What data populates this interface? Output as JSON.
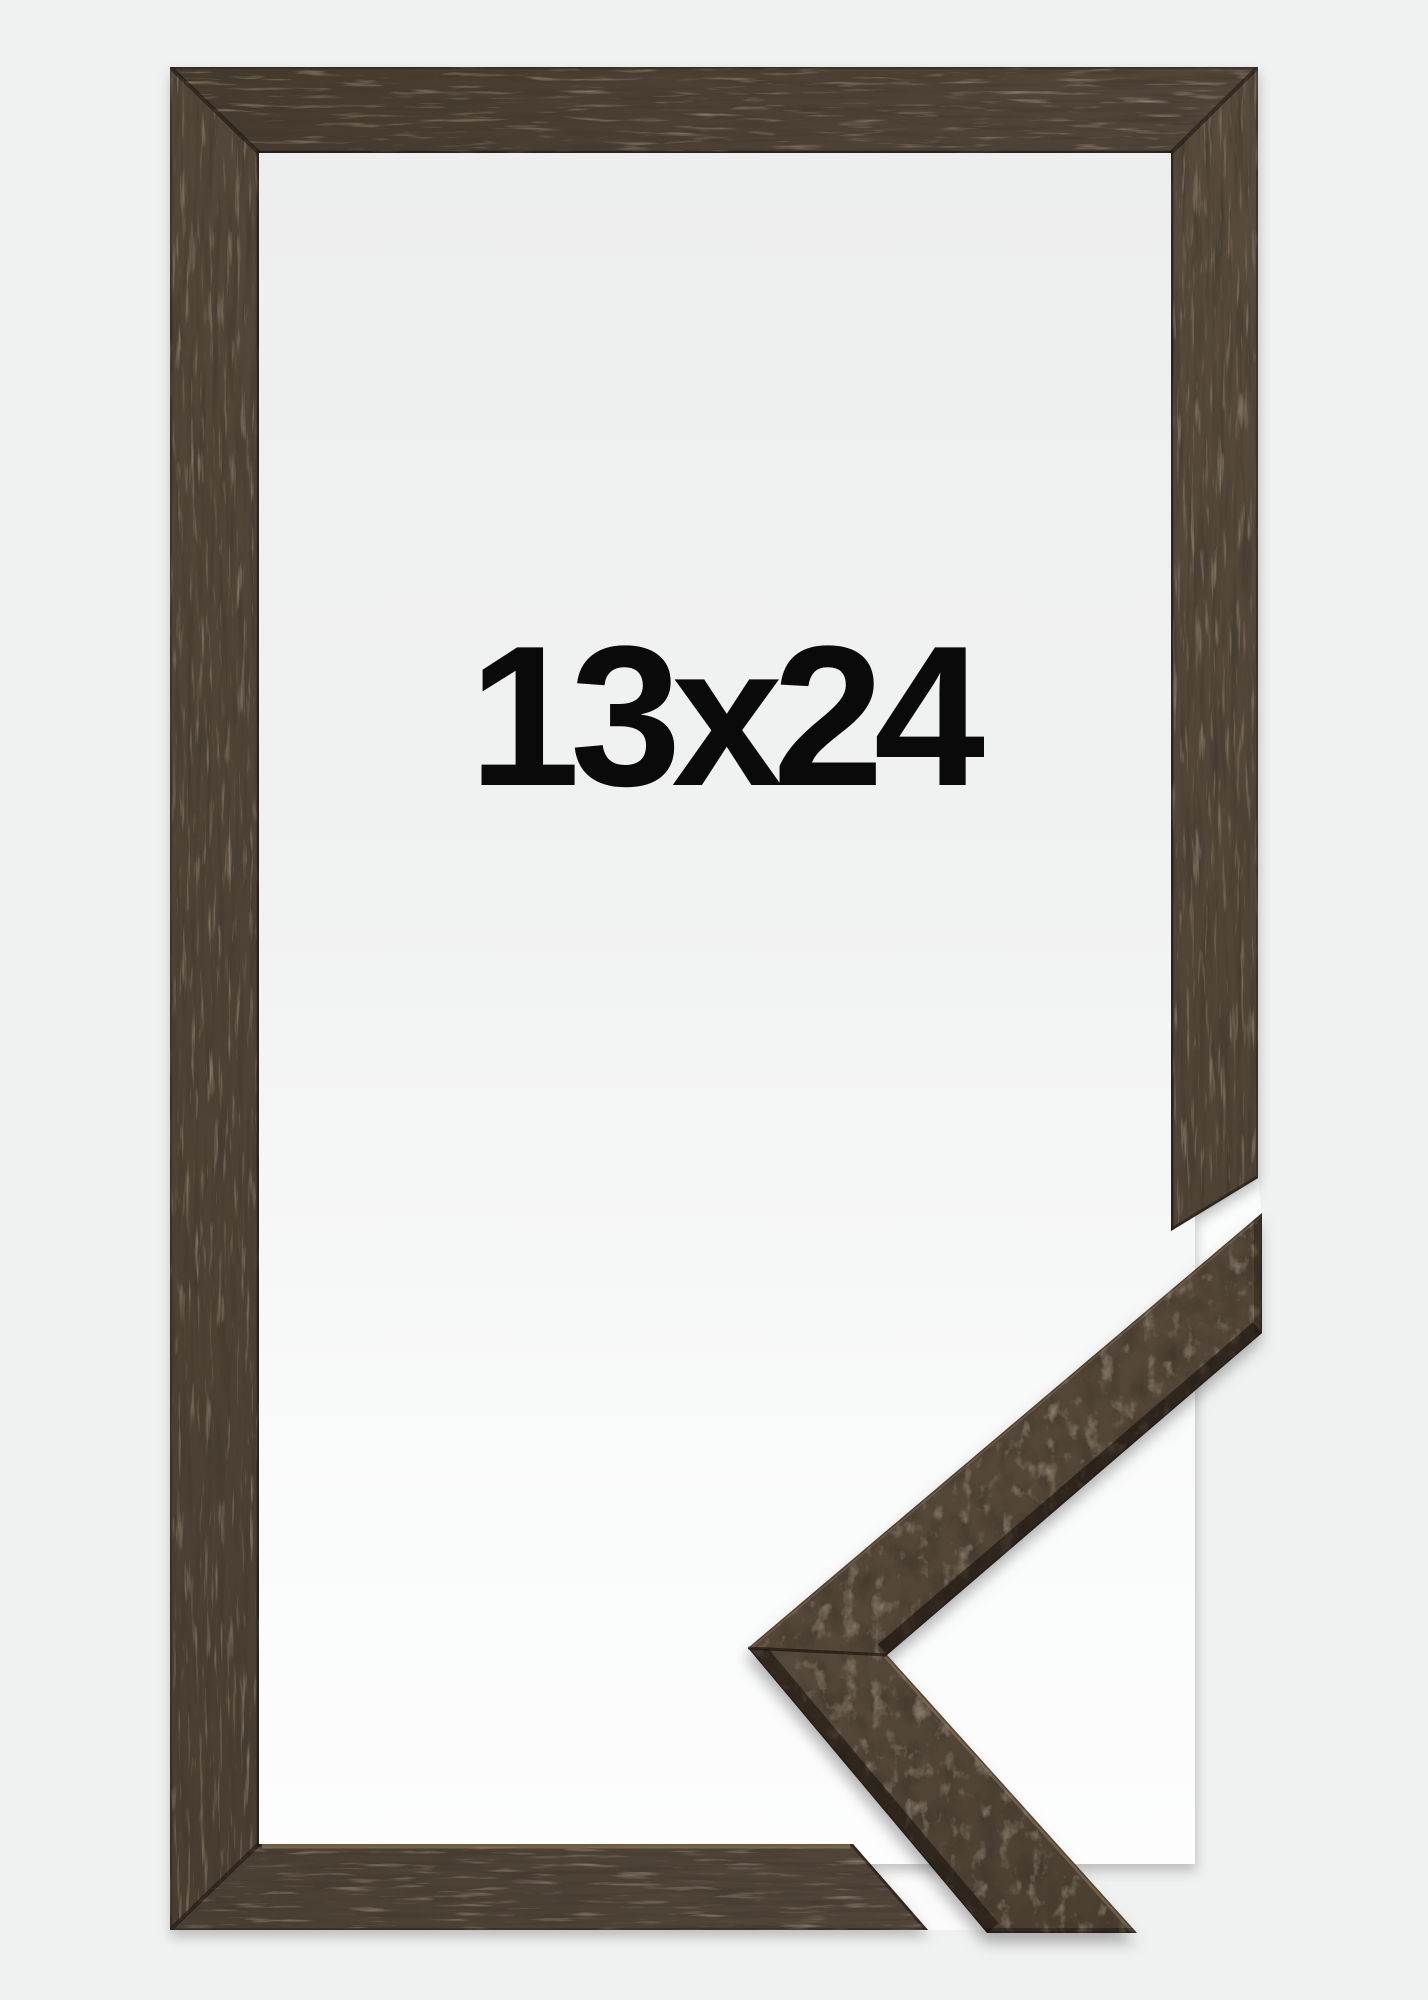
{
  "product": {
    "size_label": "13x24"
  },
  "palette": {
    "page_background": "#f0f1f1",
    "interior_white_top": "#edeeee",
    "interior_white_bottom": "#fdfdfd",
    "wood_base": "#4e4236",
    "wood_dark_streaks": "#2d241c",
    "wood_light_flecks": "#6f5e4a",
    "label_text": "#0a0a0a"
  }
}
